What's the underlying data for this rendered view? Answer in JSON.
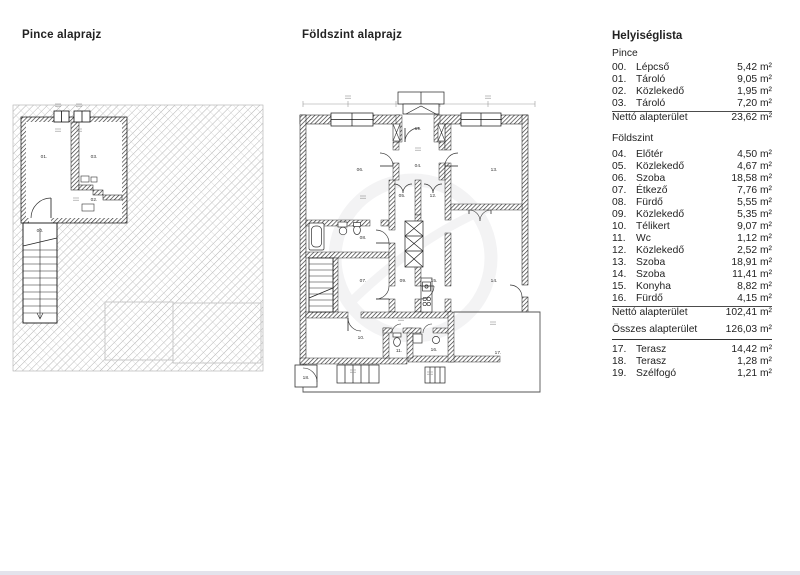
{
  "page": {
    "plan_titles": {
      "basement": "Pince alaprajz",
      "ground": "Földszint alaprajz"
    }
  },
  "plans": {
    "basement": {
      "labels": [
        "00.",
        "01.",
        "02.",
        "03."
      ]
    },
    "ground": {
      "labels": [
        "04.",
        "05.",
        "06.",
        "07.",
        "08.",
        "09.",
        "10.",
        "11.",
        "12.",
        "13.",
        "14.",
        "15.",
        "16.",
        "17.",
        "18.",
        "19."
      ]
    }
  },
  "room_list": {
    "title": "Helyiséglista",
    "sections": [
      {
        "heading": "Pince",
        "rows": [
          {
            "no": "00.",
            "name": "Lépcső",
            "area": "5,42 m²"
          },
          {
            "no": "01.",
            "name": "Tároló",
            "area": "9,05 m²"
          },
          {
            "no": "02.",
            "name": "Közlekedő",
            "area": "1,95 m²"
          },
          {
            "no": "03.",
            "name": "Tároló",
            "area": "7,20 m²"
          }
        ],
        "total": {
          "label": "Nettó alapterület",
          "area": "23,62 m²"
        }
      },
      {
        "heading": "Földszint",
        "rows": [
          {
            "no": "04.",
            "name": "Előtér",
            "area": "4,50 m²"
          },
          {
            "no": "05.",
            "name": "Közlekedő",
            "area": "4,67 m²"
          },
          {
            "no": "06.",
            "name": "Szoba",
            "area": "18,58 m²"
          },
          {
            "no": "07.",
            "name": "Étkező",
            "area": "7,76 m²"
          },
          {
            "no": "08.",
            "name": "Fürdő",
            "area": "5,55 m²"
          },
          {
            "no": "09.",
            "name": "Közlekedő",
            "area": "5,35 m²"
          },
          {
            "no": "10.",
            "name": "Télikert",
            "area": "9,07 m²"
          },
          {
            "no": "11.",
            "name": "Wc",
            "area": "1,12 m²"
          },
          {
            "no": "12.",
            "name": "Közlekedő",
            "area": "2,52 m²"
          },
          {
            "no": "13.",
            "name": "Szoba",
            "area": "18,91 m²"
          },
          {
            "no": "14.",
            "name": "Szoba",
            "area": "11,41 m²"
          },
          {
            "no": "15.",
            "name": "Konyha",
            "area": "8,82 m²"
          },
          {
            "no": "16.",
            "name": "Fürdő",
            "area": "4,15 m²"
          }
        ],
        "total": {
          "label": "Nettó alapterület",
          "area": "102,41 m²"
        },
        "grand_total": {
          "label": "Összes alapterület",
          "area": "126,03 m²"
        }
      },
      {
        "heading": "",
        "rows": [
          {
            "no": "17.",
            "name": "Terasz",
            "area": "14,42 m²"
          },
          {
            "no": "18.",
            "name": "Terasz",
            "area": "1,28 m²"
          },
          {
            "no": "19.",
            "name": "Szélfogó",
            "area": "1,21 m²"
          }
        ]
      }
    ]
  }
}
